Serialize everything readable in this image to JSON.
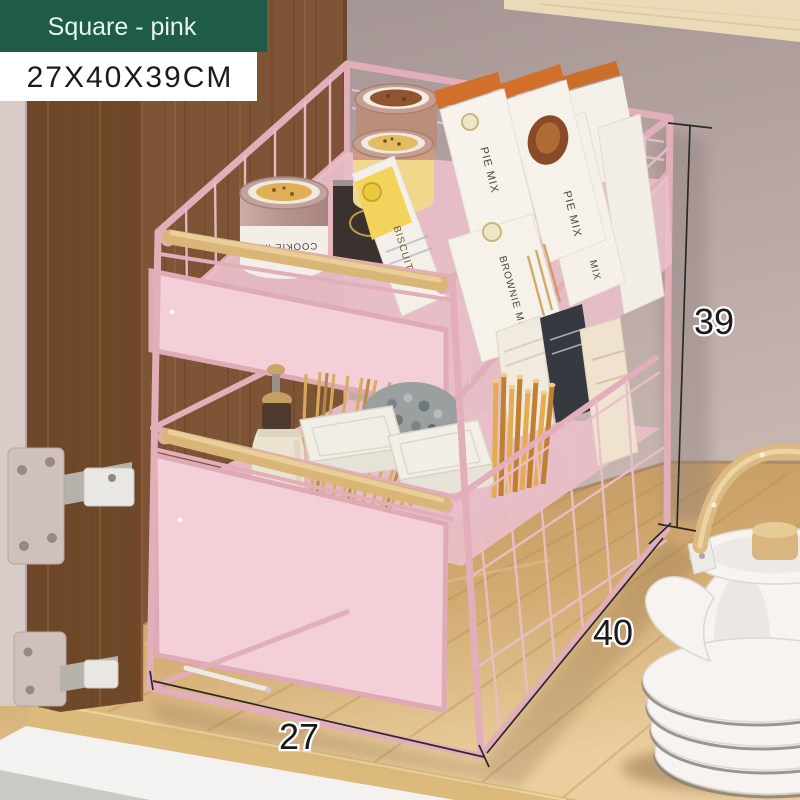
{
  "overlay": {
    "variant_badge": {
      "label": "Square - pink",
      "bg_color": "#1E5B49",
      "text_color": "#EAF4EF"
    },
    "size_badge": {
      "label": "27X40X39CM",
      "bg_color": "#FFFFFF",
      "text_color": "#1B1B1B"
    },
    "dimensions": {
      "height_cm": "39",
      "depth_cm": "40",
      "width_cm": "27"
    }
  },
  "scene": {
    "rack": {
      "colors": {
        "frame": "#E2AEB9",
        "wire": "#E9BFC9",
        "panel": "#F3CFD8",
        "deck": "#E9BEC8",
        "handle": "#D9B678"
      }
    },
    "top_tier_items": [
      {
        "type": "tin",
        "label": "COOKIE MIX"
      },
      {
        "type": "box",
        "label": "PIE MIX"
      },
      {
        "type": "box",
        "label": "PIE MIX"
      },
      {
        "type": "box",
        "label": "BISCUIT"
      },
      {
        "type": "box",
        "label": "BROWNIE MIX"
      },
      {
        "type": "box",
        "label": "MIX"
      }
    ]
  }
}
